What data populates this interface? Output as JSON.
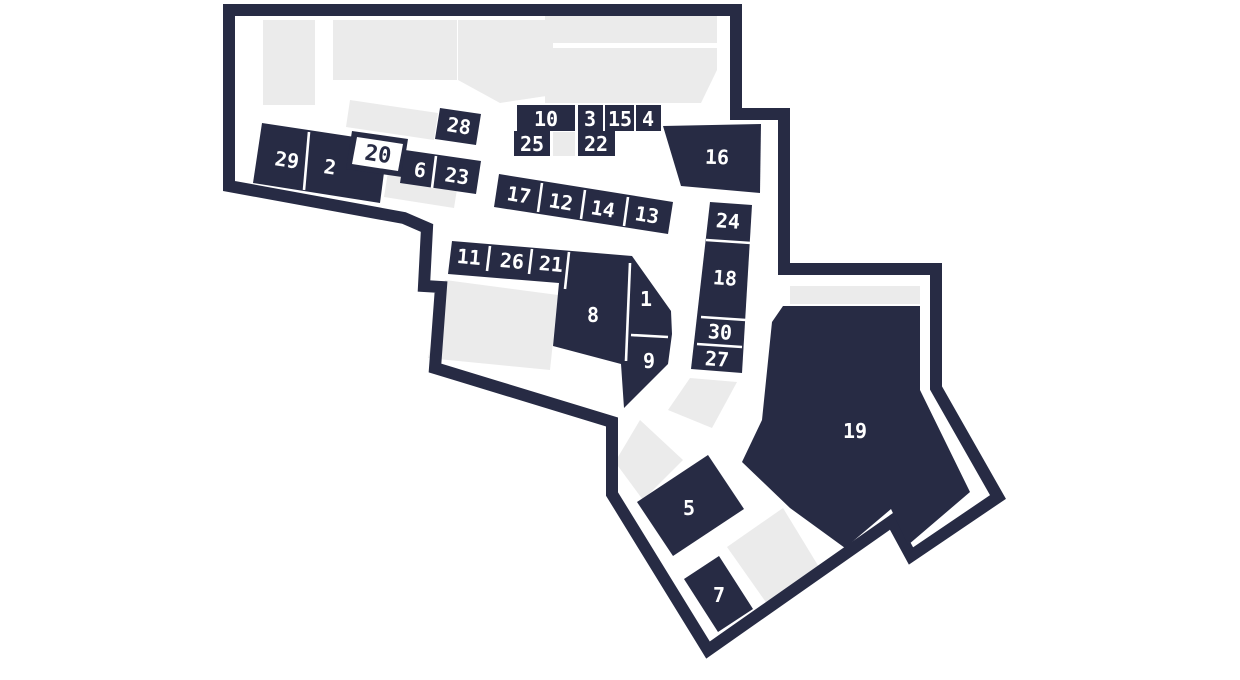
{
  "map": {
    "kind": "venue-floor-plan",
    "highlighted_unit": "20",
    "units_count": 30
  },
  "colors": {
    "unit": "#272b44",
    "outline": "#272b44",
    "area": "#ebebeb",
    "background": "#ffffff",
    "label": "#ffffff",
    "highlight_fill": "#ffffff",
    "highlight_label": "#272b44"
  },
  "units": {
    "u1": {
      "label": "1"
    },
    "u2": {
      "label": "2"
    },
    "u3": {
      "label": "3"
    },
    "u4": {
      "label": "4"
    },
    "u5": {
      "label": "5"
    },
    "u6": {
      "label": "6"
    },
    "u7": {
      "label": "7"
    },
    "u8": {
      "label": "8"
    },
    "u9": {
      "label": "9"
    },
    "u10": {
      "label": "10"
    },
    "u11": {
      "label": "11"
    },
    "u12": {
      "label": "12"
    },
    "u13": {
      "label": "13"
    },
    "u14": {
      "label": "14"
    },
    "u15": {
      "label": "15"
    },
    "u16": {
      "label": "16"
    },
    "u17": {
      "label": "17"
    },
    "u18": {
      "label": "18"
    },
    "u19": {
      "label": "19"
    },
    "u20": {
      "label": "20"
    },
    "u21": {
      "label": "21"
    },
    "u22": {
      "label": "22"
    },
    "u23": {
      "label": "23"
    },
    "u24": {
      "label": "24"
    },
    "u25": {
      "label": "25"
    },
    "u26": {
      "label": "26"
    },
    "u27": {
      "label": "27"
    },
    "u28": {
      "label": "28"
    },
    "u29": {
      "label": "29"
    },
    "u30": {
      "label": "30"
    }
  }
}
